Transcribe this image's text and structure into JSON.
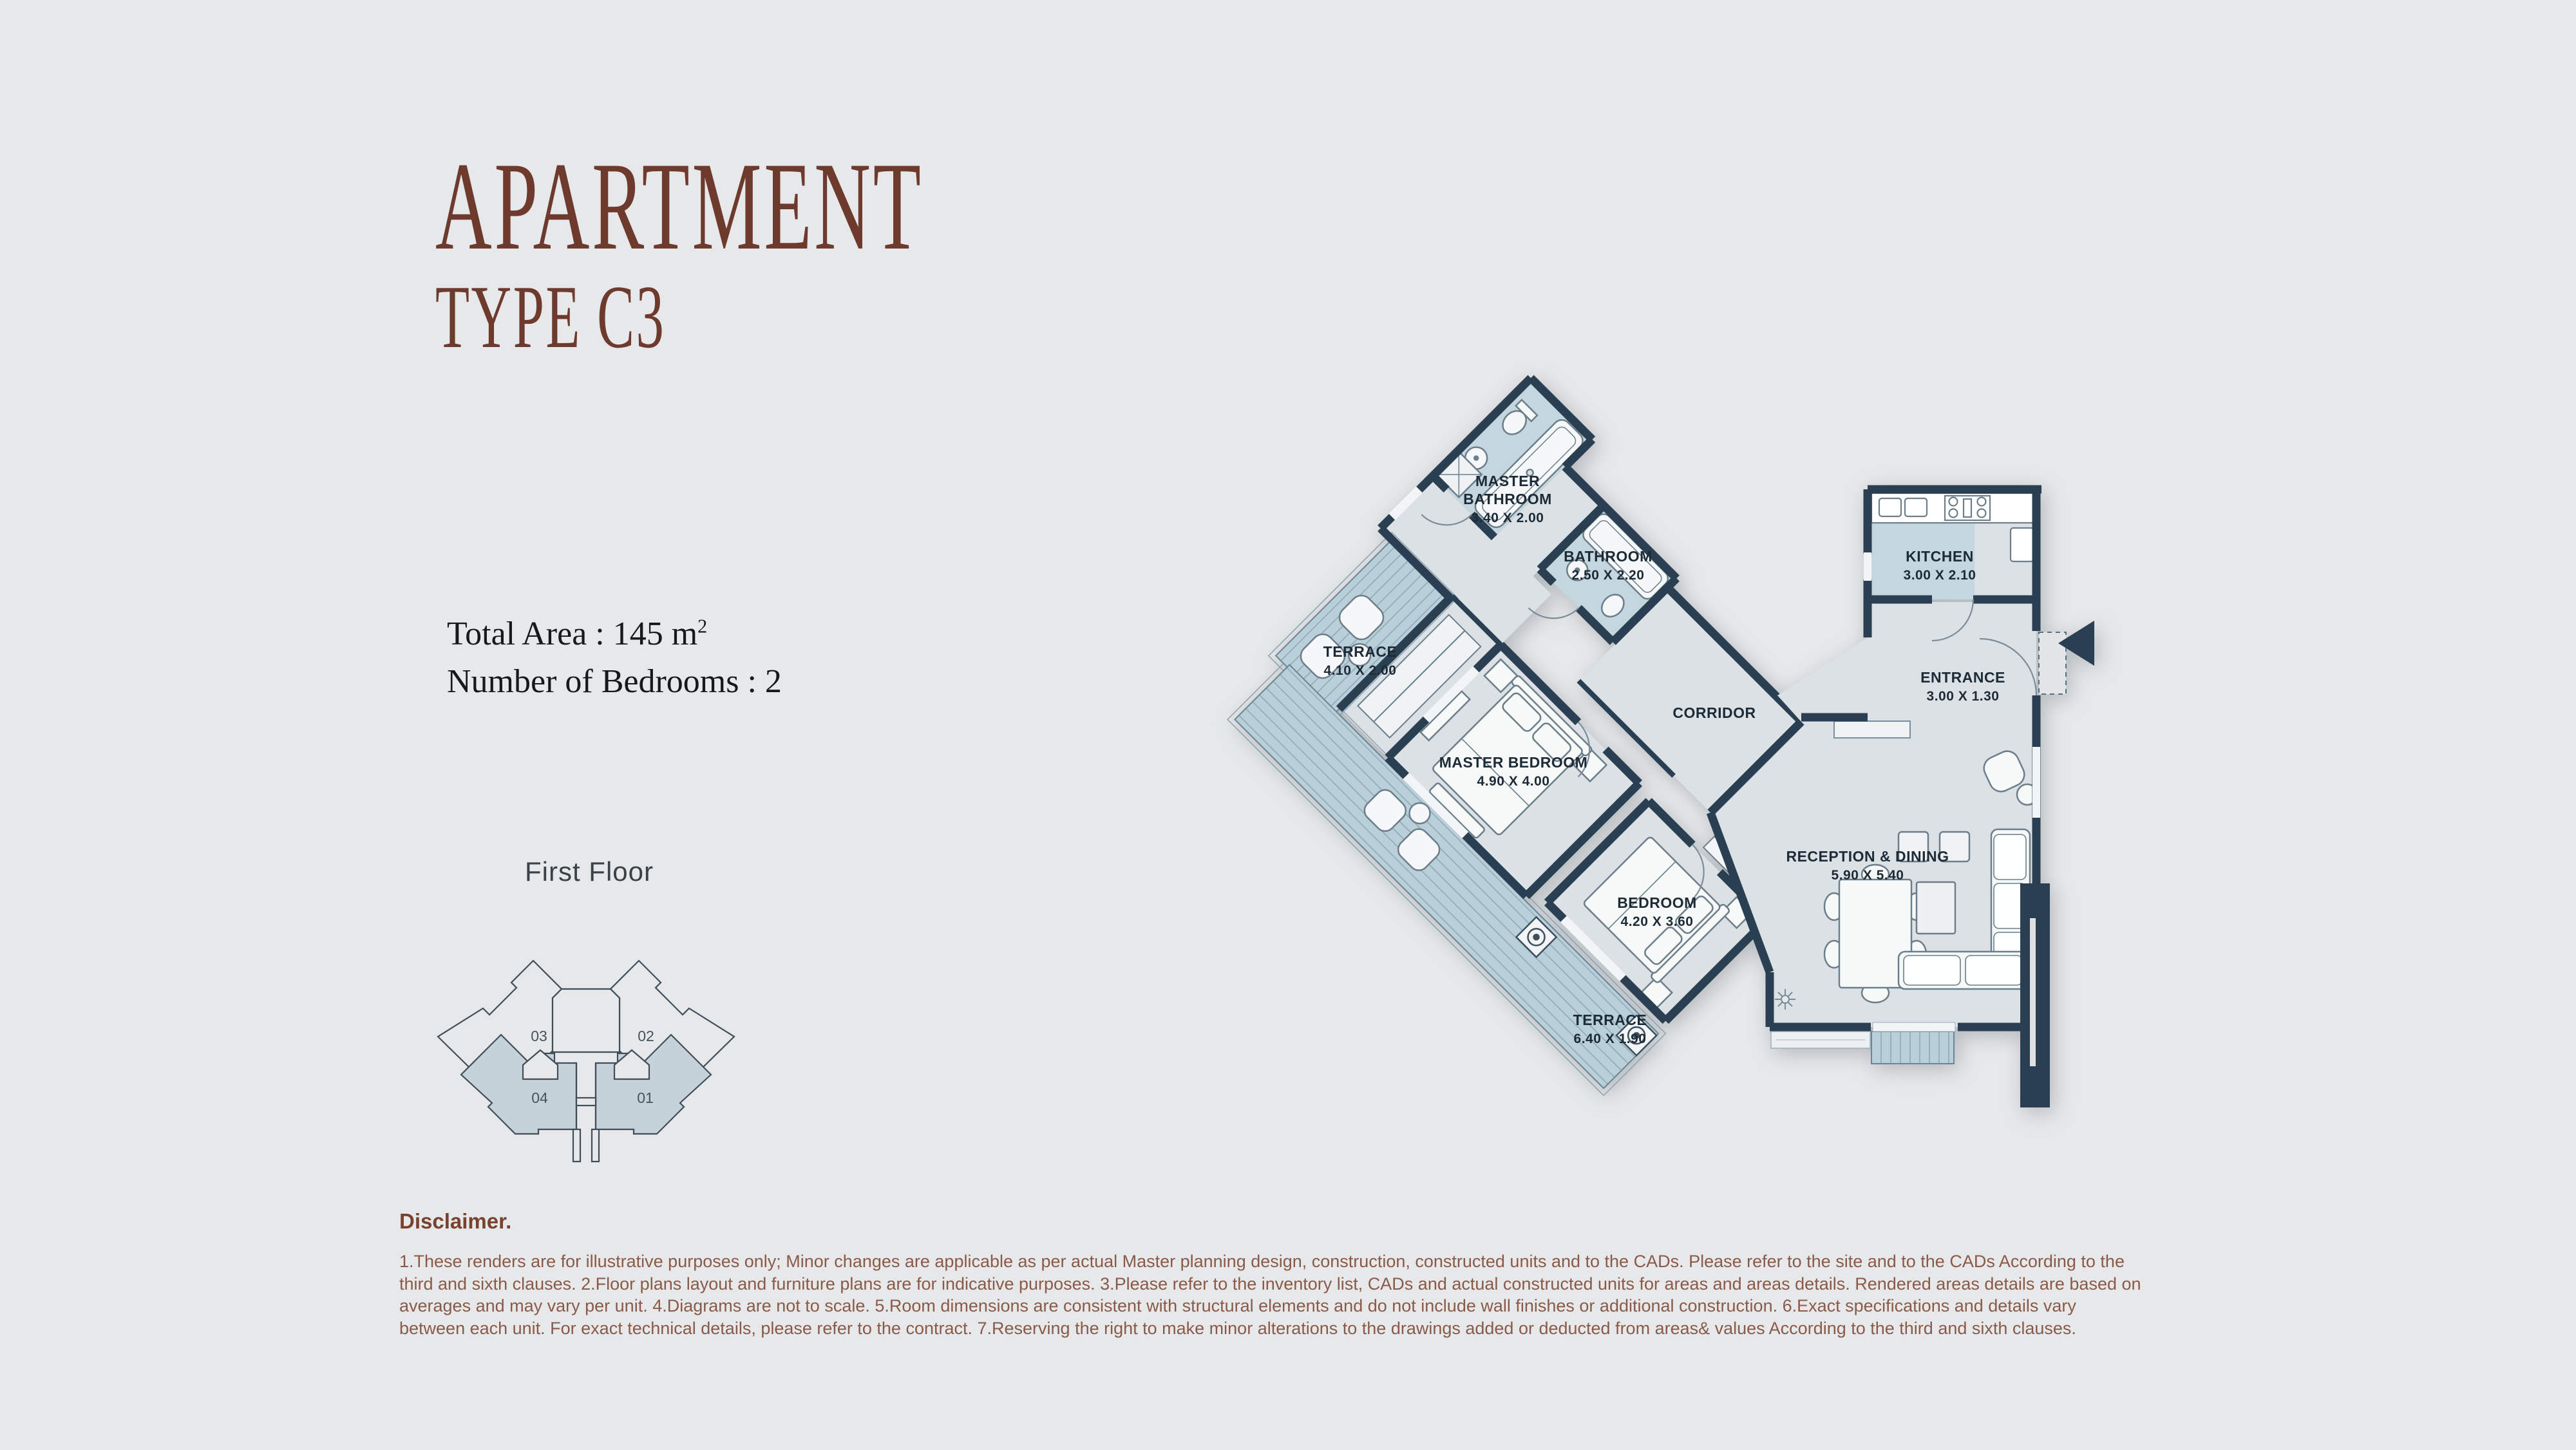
{
  "page": {
    "bg": "#e7e8e9",
    "accent": "#6e3a2d"
  },
  "header": {
    "title": "APARTMENT",
    "subtitle": "TYPE C3"
  },
  "details": {
    "total_area_prefix": "Total Area : 145 m",
    "total_area_sup": "2",
    "bedrooms": "Number of Bedrooms : 2"
  },
  "key_plan": {
    "floor_label": "First Floor",
    "units": {
      "tl": "03",
      "tr": "02",
      "bl": "04",
      "br": "01"
    },
    "highlight_color": "#c5d2da"
  },
  "floor_plan": {
    "colors": {
      "wall": "#2a4052",
      "room_floor": "#dce1e5",
      "bath_floor": "#c4d6de",
      "terrace_floor": "#b9cfd9"
    },
    "rooms": {
      "master_bathroom": {
        "l1": "MASTER",
        "l2": "BATHROOM",
        "dims": "3.40 X 2.00"
      },
      "bathroom": {
        "name": "BATHROOM",
        "dims": "2.50 X 2.20"
      },
      "terrace_1": {
        "name": "TERRACE",
        "dims": "4.10 X 2.00"
      },
      "master_bedroom": {
        "name": "MASTER BEDROOM",
        "dims": "4.90 X 4.00"
      },
      "corridor": {
        "name": "CORRIDOR"
      },
      "bedroom": {
        "name": "BEDROOM",
        "dims": "4.20 X 3.60"
      },
      "terrace_2": {
        "name": "TERRACE",
        "dims": "6.40 X 1.90"
      },
      "kitchen": {
        "name": "KITCHEN",
        "dims": "3.00 X 2.10"
      },
      "entrance": {
        "name": "ENTRANCE",
        "dims": "3.00 X 1.30"
      },
      "reception": {
        "name": "RECEPTION & DINING",
        "dims": "5.90 X 5.40"
      }
    }
  },
  "disclaimer": {
    "title": "Disclaimer.",
    "body": "1.These renders are for illustrative purposes only; Minor changes are applicable as per actual Master planning design, construction, constructed units and to the CADs. Please refer to the site and to the CADs According to the third and sixth clauses. 2.Floor plans layout and furniture plans are for indicative purposes. 3.Please refer to the inventory list, CADs and actual constructed units for areas and areas details. Rendered areas details are based on averages and may vary per unit. 4.Diagrams are not to scale. 5.Room dimensions are consistent with structural elements and do not include wall finishes or additional construction. 6.Exact specifications and details vary between each unit. For exact technical details, please refer to the contract. 7.Reserving the right to make minor alterations to the drawings  added or deducted from areas& values According to the third and sixth clauses."
  }
}
